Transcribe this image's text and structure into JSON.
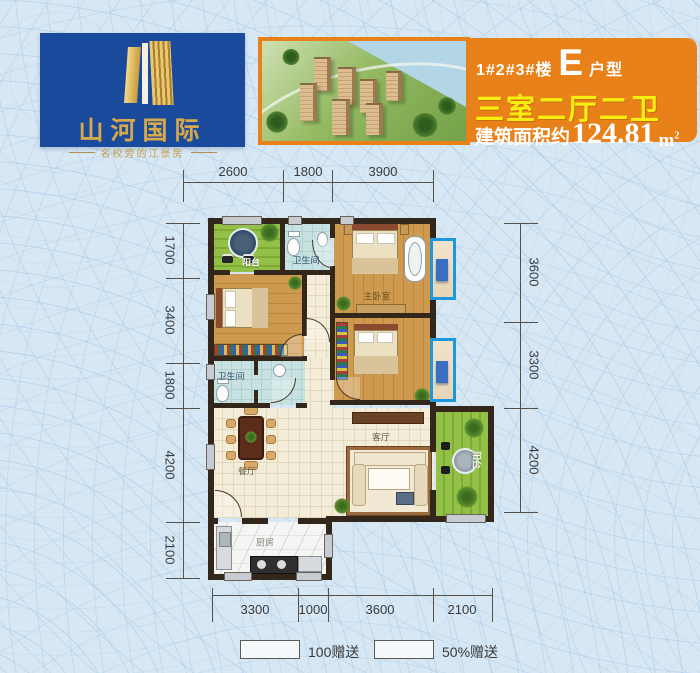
{
  "branding": {
    "logo_title": "山河国际",
    "logo_tagline": "名校旁的江景房",
    "logo_bg_color": "#1a4a9c",
    "logo_gold_color": "#d8a94a"
  },
  "banner": {
    "buildings": "1#2#3#楼",
    "unit_letter": "E",
    "unit_label": "户型",
    "layout": "三室二厅二卫",
    "area_prefix": "建筑面积约",
    "area_value": "124.81",
    "area_unit_base": "m",
    "area_unit_exp": "2",
    "bg_color": "#e8811a",
    "layout_text_color": "#f6ee10"
  },
  "dimensions": {
    "top": [
      "2600",
      "1800",
      "3900"
    ],
    "left": [
      "1700",
      "3400",
      "1800",
      "4200",
      "2100"
    ],
    "right": [
      "3600",
      "3300",
      "4200"
    ],
    "bottom": [
      "3300",
      "1000",
      "3600",
      "2100"
    ]
  },
  "rooms": {
    "balcony_top": "阳台",
    "bath_top": "卫生间",
    "master_bedroom": "主卧室",
    "bath_mid": "卫生间",
    "dining": "餐厅",
    "living": "客厅",
    "balcony_right": "阳台",
    "kitchen": "厨房"
  },
  "legend": {
    "item1": "100赠送",
    "item2": "50%赠送"
  }
}
